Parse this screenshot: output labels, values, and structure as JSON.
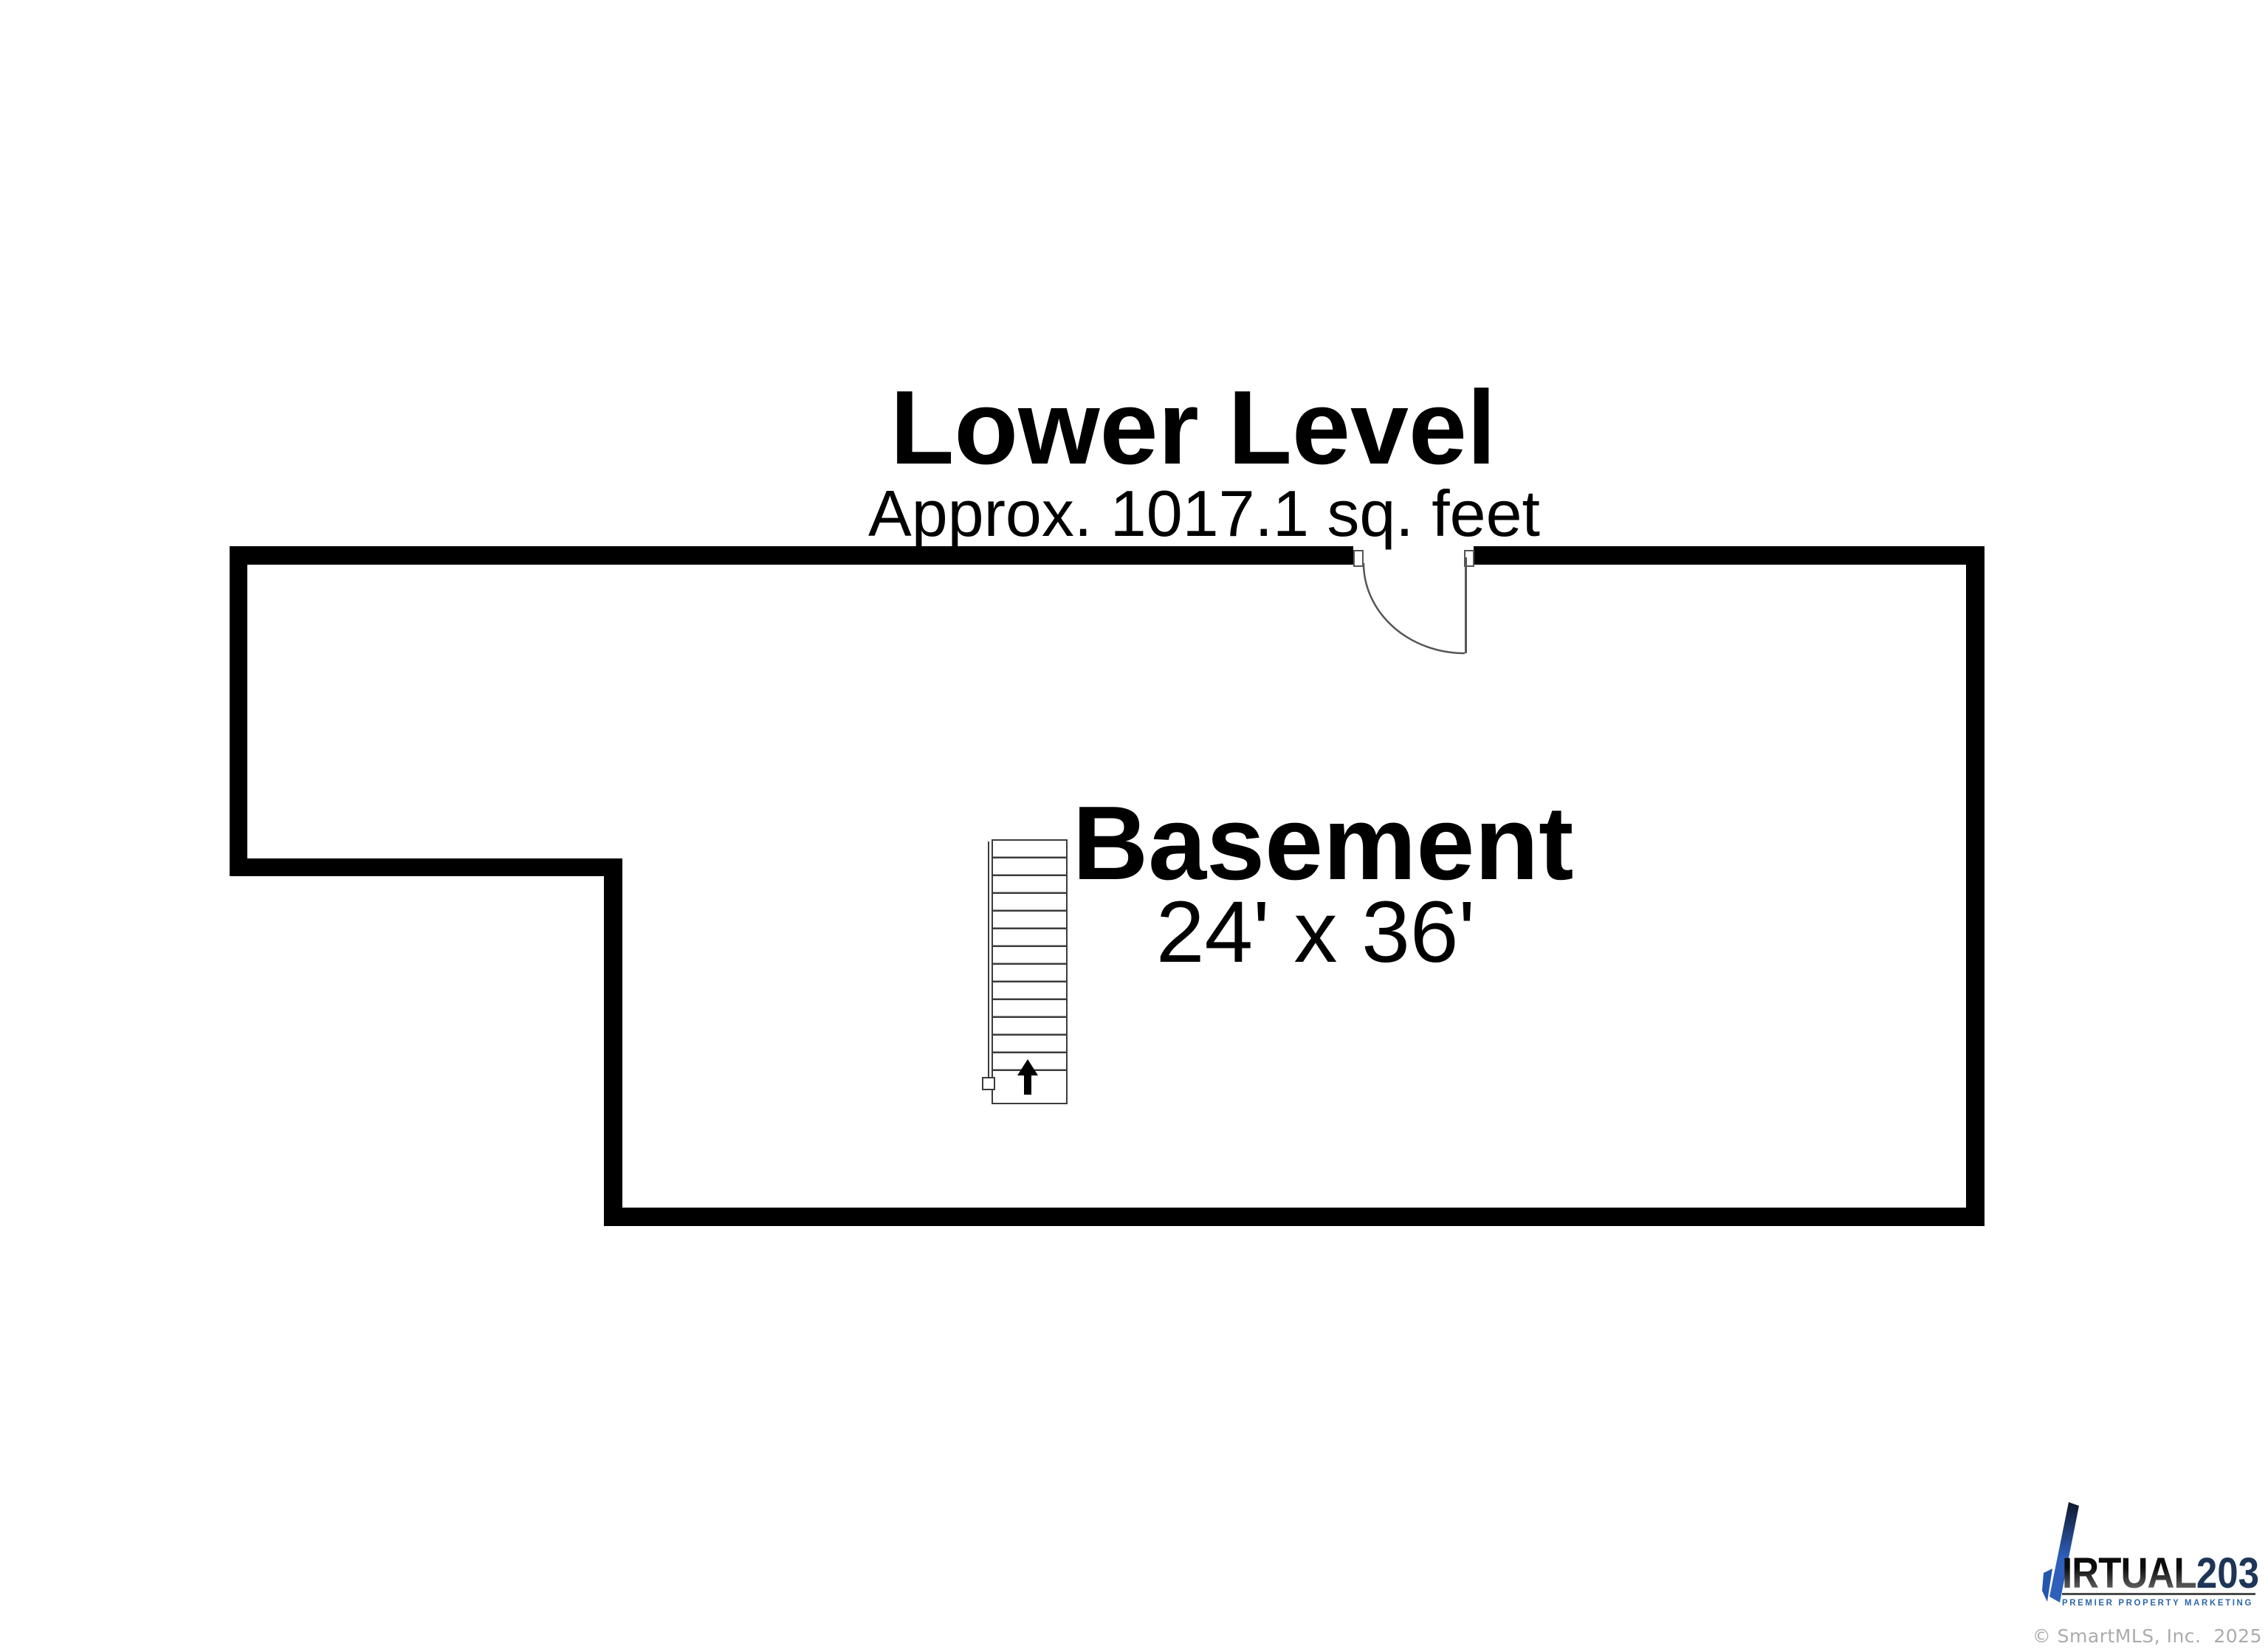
{
  "header": {
    "title": "Lower Level",
    "subtitle": "Approx. 1017.1 sq. feet"
  },
  "room": {
    "name": "Basement",
    "dimensions": "24' x 36'"
  },
  "floorplan": {
    "wall_color": "#000000",
    "stair_arrow_direction": "up",
    "door_swing": "hinged-right-opens-into-room"
  },
  "branding": {
    "logo_fragment_text": "IRTUAL",
    "logo_number_text": "203",
    "tagline": "PREMIER PROPERTY MARKETING",
    "logo_blue": "#2e5fba",
    "logo_navy": "#1d3557",
    "tagline_blue": "#2d66a8"
  },
  "footer": {
    "copyright": "© SmartMLS, Inc.  2025"
  }
}
